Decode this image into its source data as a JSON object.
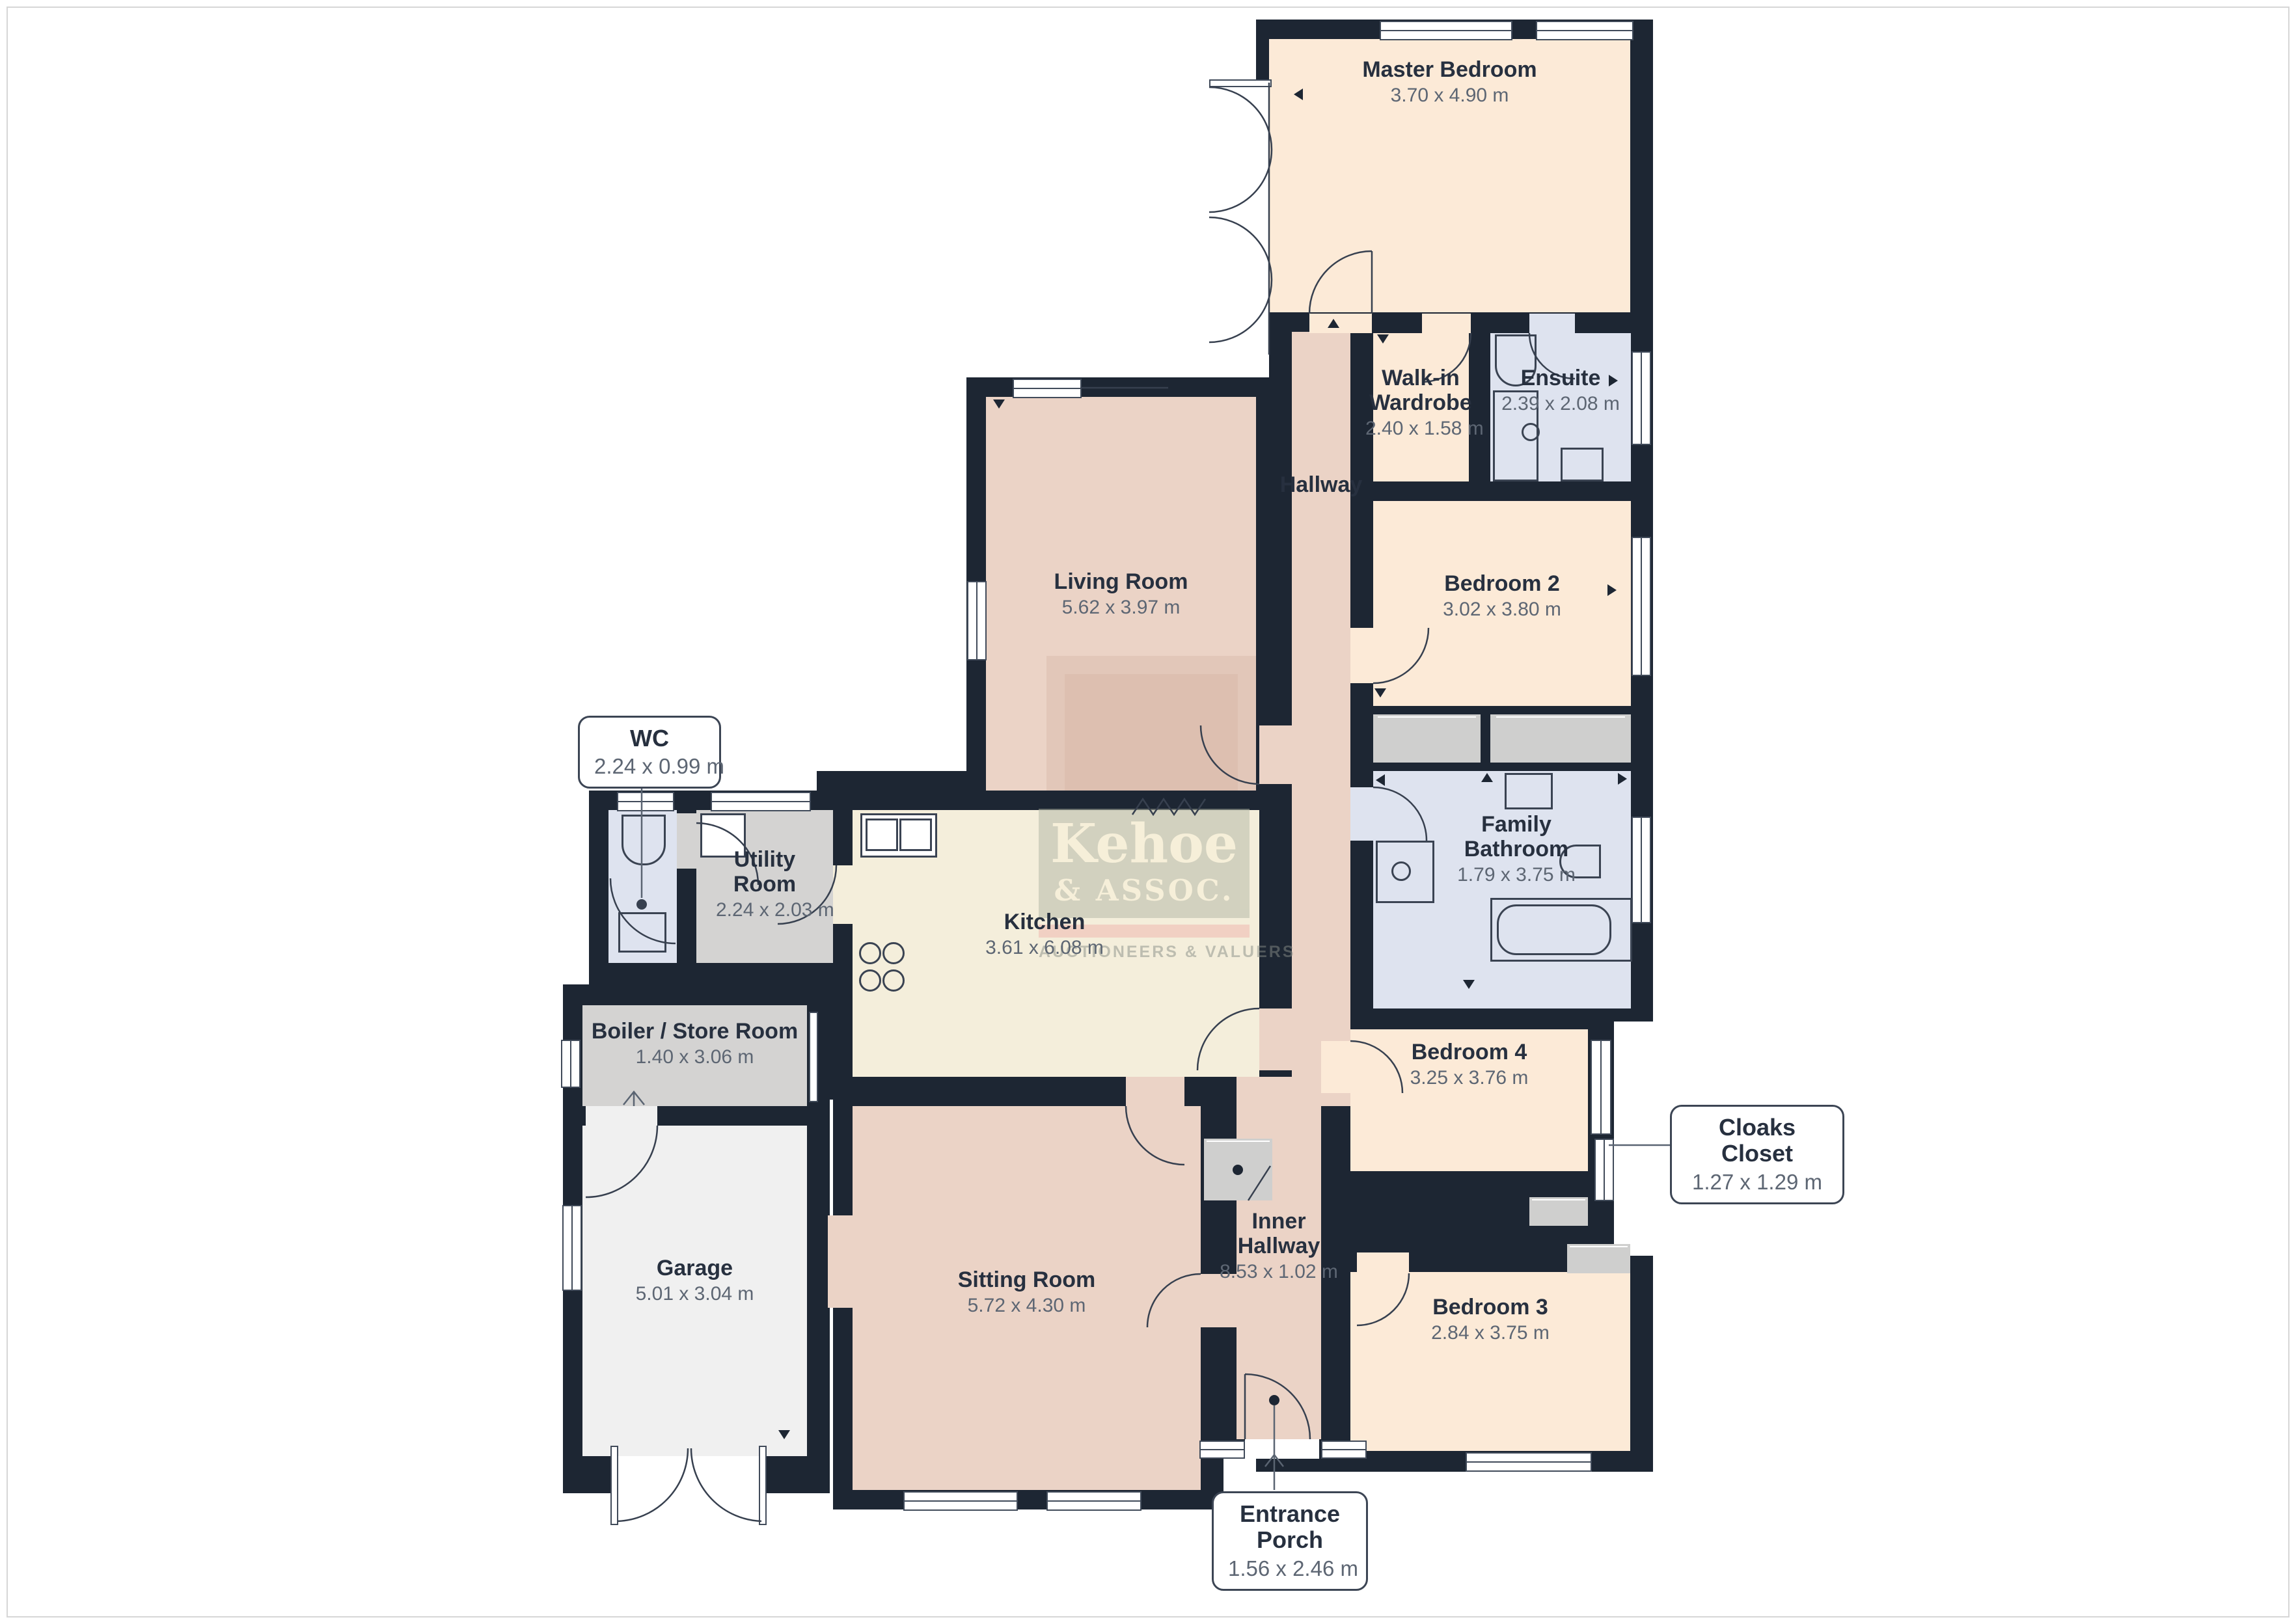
{
  "rooms": [
    {
      "id": "master-bedroom",
      "name": "Master Bedroom",
      "dims": "3.70 x 4.90 m"
    },
    {
      "id": "walk-in-wardrobe",
      "name": "Walk-in Wardrobe",
      "dims": "2.40 x 1.58 m"
    },
    {
      "id": "ensuite",
      "name": "Ensuite",
      "dims": "2.39 x 2.08 m"
    },
    {
      "id": "hallway",
      "name": "Hallway",
      "dims": ""
    },
    {
      "id": "bedroom-2",
      "name": "Bedroom 2",
      "dims": "3.02 x 3.80 m"
    },
    {
      "id": "family-bathroom",
      "name": "Family Bathroom",
      "dims": "1.79 x 3.75 m"
    },
    {
      "id": "bedroom-4",
      "name": "Bedroom 4",
      "dims": "3.25 x 3.76 m"
    },
    {
      "id": "bedroom-3",
      "name": "Bedroom 3",
      "dims": "2.84 x 3.75 m"
    },
    {
      "id": "living-room",
      "name": "Living Room",
      "dims": "5.62 x 3.97 m"
    },
    {
      "id": "kitchen",
      "name": "Kitchen",
      "dims": "3.61 x 6.08 m"
    },
    {
      "id": "utility-room",
      "name": "Utility Room",
      "dims": "2.24 x 2.03 m"
    },
    {
      "id": "boiler-store-room",
      "name": "Boiler / Store Room",
      "dims": "1.40 x 3.06 m"
    },
    {
      "id": "garage",
      "name": "Garage",
      "dims": "5.01 x 3.04 m"
    },
    {
      "id": "sitting-room",
      "name": "Sitting Room",
      "dims": "5.72 x 4.30 m"
    },
    {
      "id": "inner-hallway",
      "name": "Inner Hallway",
      "dims": "8.53 x 1.02 m"
    }
  ],
  "callouts": [
    {
      "id": "wc",
      "name": "WC",
      "dims": "2.24 x 0.99 m"
    },
    {
      "id": "cloaks-closet",
      "name": "Cloaks Closet",
      "dims": "1.27 x 1.29 m"
    },
    {
      "id": "entrance-porch",
      "name": "Entrance Porch",
      "dims": "1.56 x 2.46 m"
    }
  ],
  "watermark": {
    "title": "Kehoe",
    "subtitle": "& ASSOC.",
    "footer": "AUCTIONEERS & VALUERS"
  },
  "colors": {
    "wall": "#1d2633",
    "bedroom": "#fcead7",
    "hall": "#ebd3c6",
    "bath": "#dee3ef",
    "utility": "#d4d3d2",
    "garage": "#f0f0f0",
    "kitchen": "#f4eedb",
    "accent_band": "#efb4ad"
  }
}
